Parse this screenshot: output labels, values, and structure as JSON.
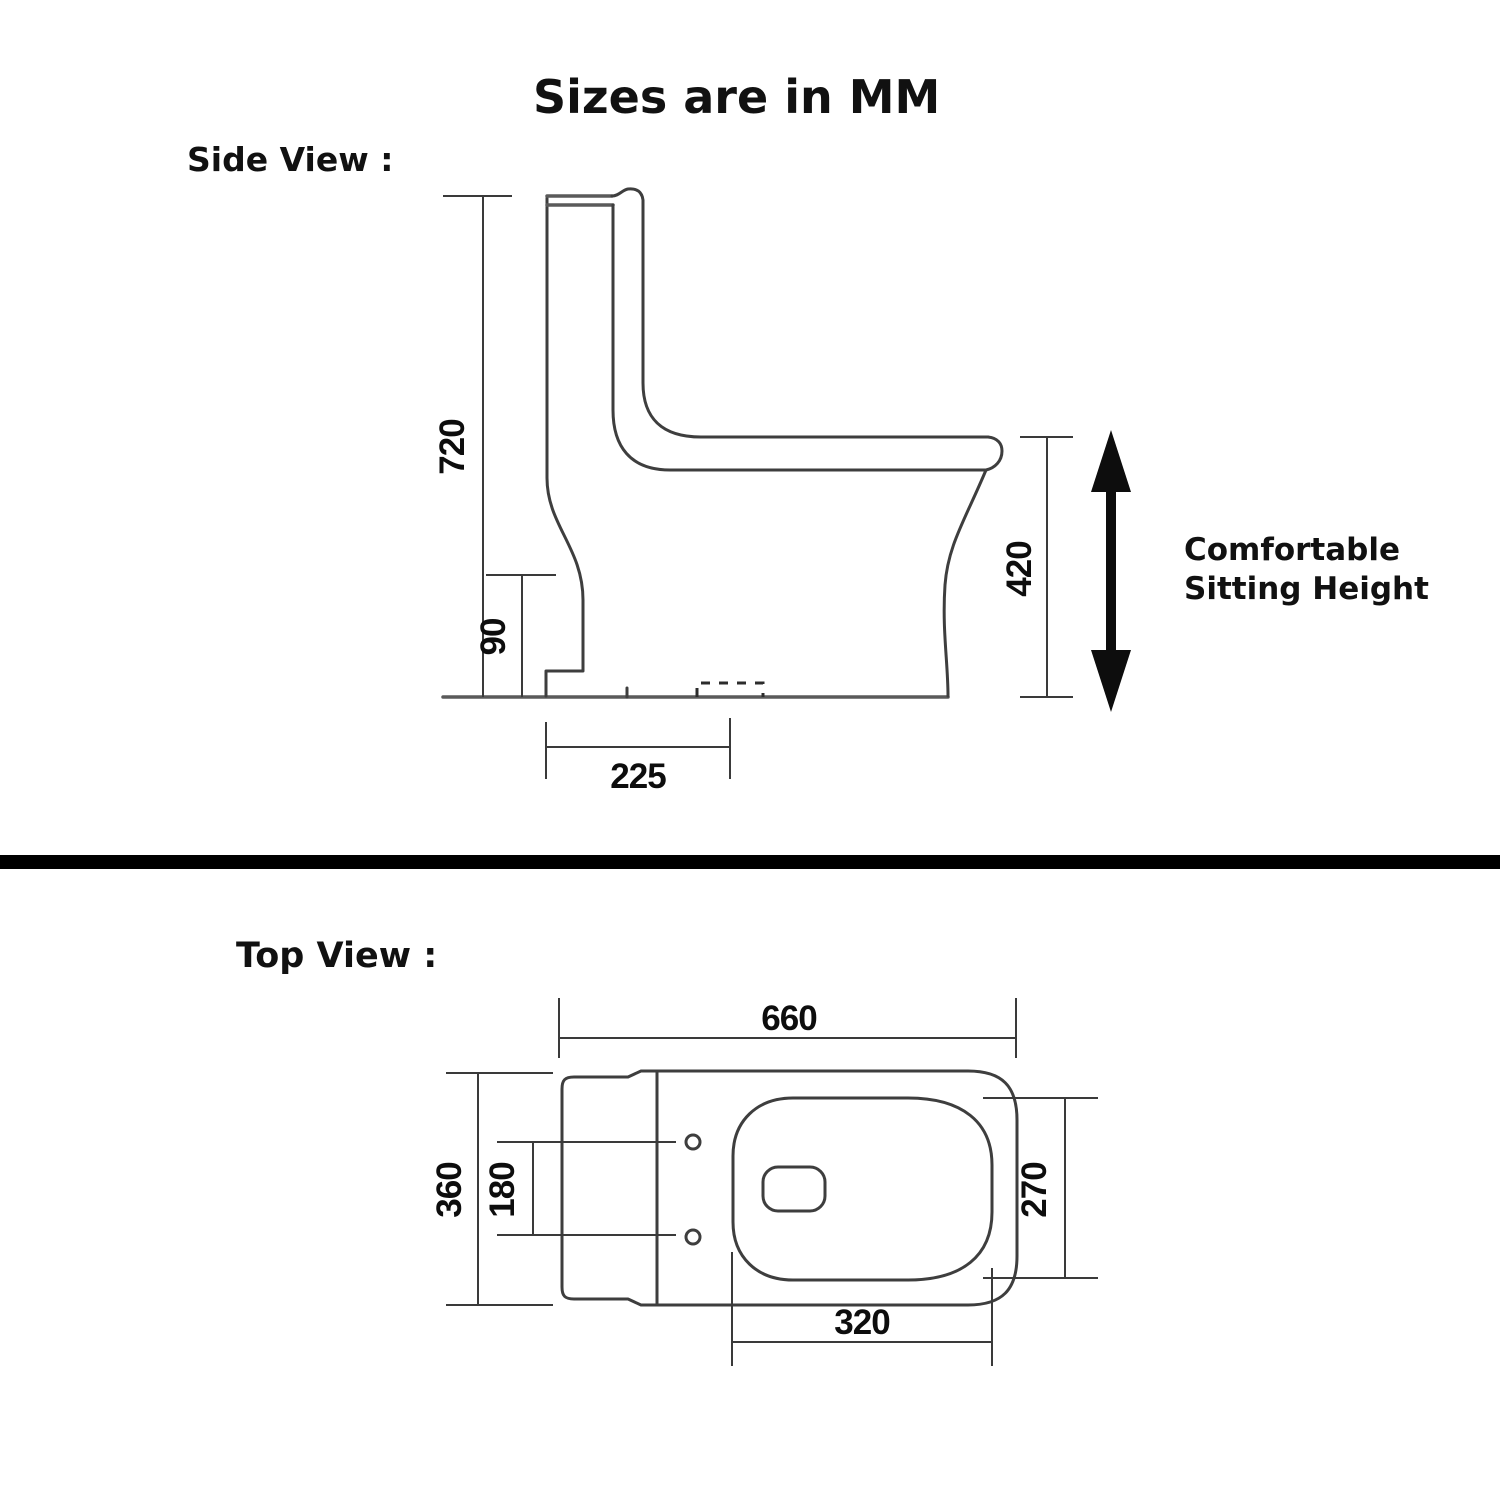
{
  "title": "Sizes are in MM",
  "side_view": {
    "label": "Side View :",
    "dims": {
      "total_height": "720",
      "trap_height": "90",
      "outlet_offset": "225",
      "sitting_height": "420"
    },
    "note_line1": "Comfortable",
    "note_line2": "Sitting Height"
  },
  "top_view": {
    "label": "Top View :",
    "dims": {
      "total_length": "660",
      "total_width": "360",
      "bolt_spacing": "180",
      "seat_width": "270",
      "seat_length": "320"
    }
  },
  "colors": {
    "background": "#ffffff",
    "line": "#3e3e3e",
    "dimension_line": "#3a3a3a",
    "text": "#0d0d0d",
    "divider": "#000000"
  }
}
